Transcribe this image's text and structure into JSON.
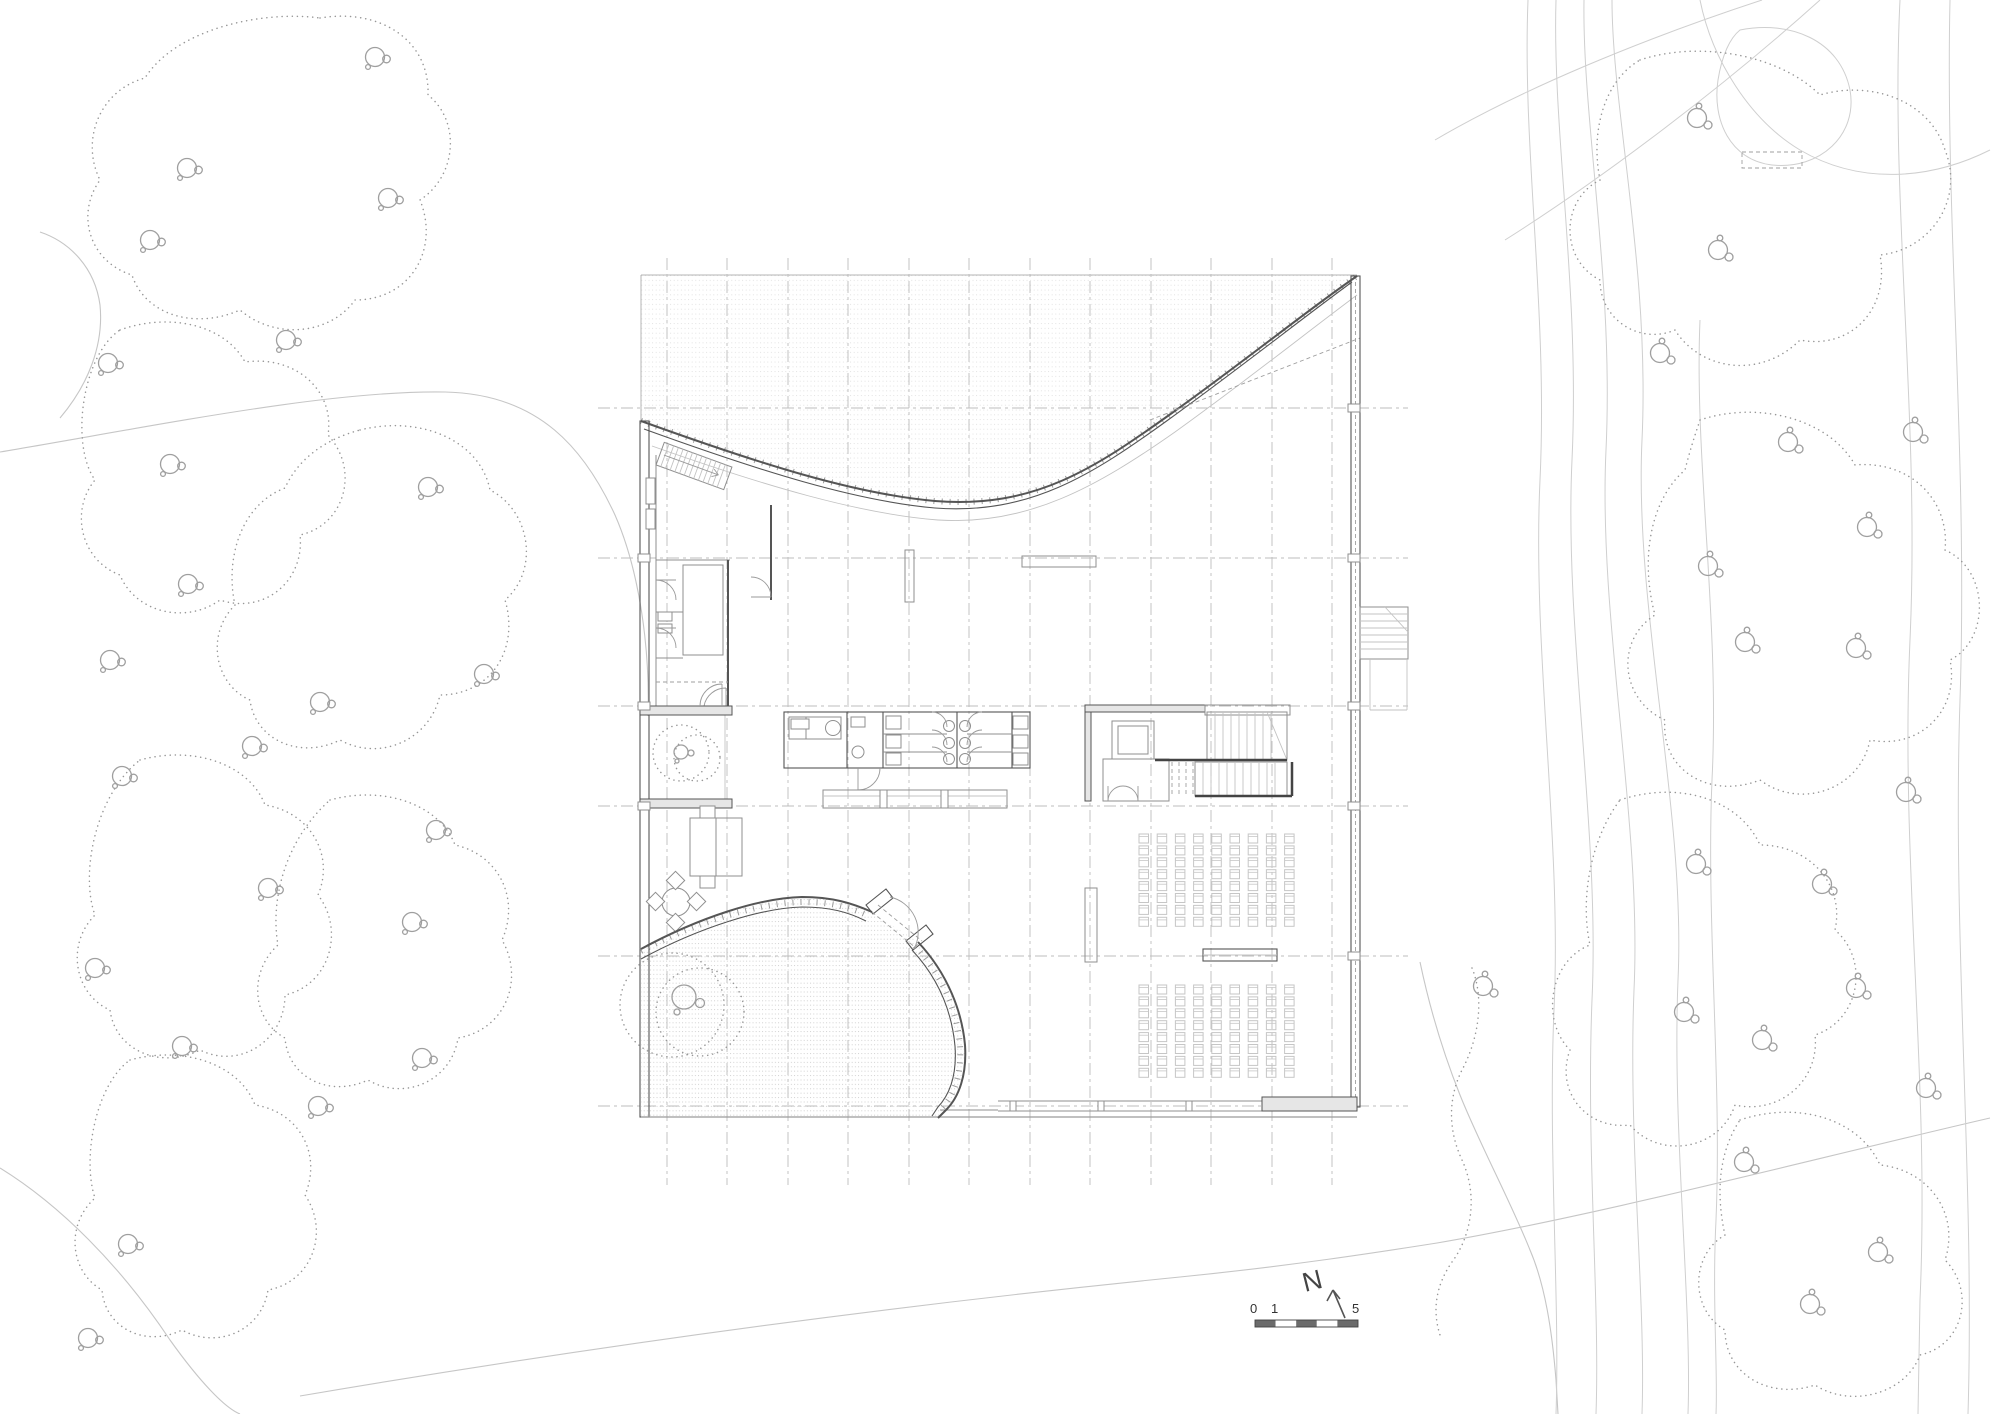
{
  "scale_bar": {
    "labels": [
      "0",
      "1",
      "5"
    ],
    "bar_x": 1255,
    "bar_y": 1320,
    "bar_w": 103,
    "bar_h": 7,
    "dark": "#6b6b6b"
  },
  "north": {
    "label": "N"
  },
  "grid": {
    "vertical_x": [
      667,
      727,
      788,
      848,
      909,
      969,
      1030,
      1090,
      1151,
      1211,
      1272,
      1332
    ],
    "vertical_y": [
      258,
      1185
    ],
    "horizontal_y": [
      408,
      558,
      706,
      806,
      956,
      1106
    ],
    "horizontal_x": [
      598,
      1408
    ]
  },
  "seating": {
    "cols": 9,
    "rows": 8,
    "dx": 18.2,
    "dy": 11.9,
    "w": 9.5,
    "h": 9,
    "blocks": [
      {
        "x": 1139,
        "y": 834
      },
      {
        "x": 1139,
        "y": 985
      }
    ]
  },
  "trees": {
    "west": [
      [
        375,
        57
      ],
      [
        187,
        168
      ],
      [
        388,
        198
      ],
      [
        150,
        240
      ],
      [
        108,
        363
      ],
      [
        286,
        340
      ],
      [
        170,
        464
      ],
      [
        428,
        487
      ],
      [
        188,
        584
      ],
      [
        110,
        660
      ],
      [
        484,
        674
      ],
      [
        320,
        702
      ],
      [
        252,
        746
      ],
      [
        122,
        776
      ],
      [
        436,
        830
      ],
      [
        268,
        888
      ],
      [
        412,
        922
      ],
      [
        95,
        968
      ],
      [
        182,
        1046
      ],
      [
        422,
        1058
      ],
      [
        318,
        1106
      ],
      [
        128,
        1244
      ],
      [
        88,
        1338
      ]
    ],
    "east": [
      [
        1697,
        118
      ],
      [
        1718,
        250
      ],
      [
        1660,
        353
      ],
      [
        1788,
        442
      ],
      [
        1867,
        527
      ],
      [
        1913,
        432
      ],
      [
        1708,
        566
      ],
      [
        1745,
        642
      ],
      [
        1856,
        648
      ],
      [
        1696,
        864
      ],
      [
        1906,
        792
      ],
      [
        1822,
        884
      ],
      [
        1684,
        1012
      ],
      [
        1762,
        1040
      ],
      [
        1856,
        988
      ],
      [
        1926,
        1088
      ],
      [
        1744,
        1162
      ],
      [
        1878,
        1252
      ],
      [
        1810,
        1304
      ],
      [
        1483,
        986
      ]
    ]
  },
  "colors": {
    "wall": "#555555",
    "seat": "#c6c6c6",
    "grid": "#bdbdbd",
    "canopy": "#979797",
    "ink": "#3c3c3c"
  }
}
